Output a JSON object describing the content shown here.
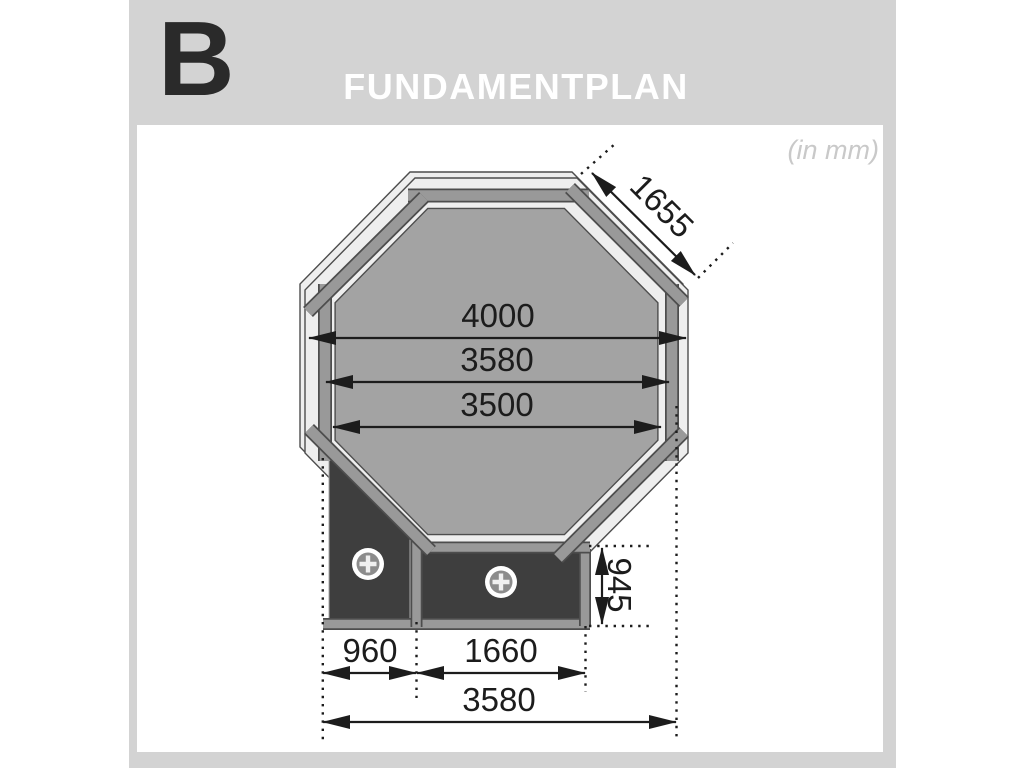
{
  "header": {
    "section_letter": "B",
    "title": "FUNDAMENTPLAN"
  },
  "drawing": {
    "units_note": "(in mm)",
    "dimensions": {
      "side_top_right": "1655",
      "overall_width": "4000",
      "frame_width": "3580",
      "inner_width": "3500",
      "bay_left": "960",
      "bay_right": "1660",
      "bottom_total": "3580",
      "bay_depth": "945"
    },
    "icons": {
      "anchor_marker": "plus-circle-icon"
    },
    "colors": {
      "panel_gray": "#d3d3d3",
      "octagon_frame": "#eeeeee",
      "octagon_fill": "#a3a3a3",
      "beam_gray": "#999999",
      "outline_gray": "#4d4d4d",
      "slab_dark": "#3e3e3e",
      "dimension_ink": "#1c1c1c",
      "title_white": "#ffffff",
      "letter_black": "#2a2a2a",
      "note_gray": "#c9c9c9"
    }
  }
}
